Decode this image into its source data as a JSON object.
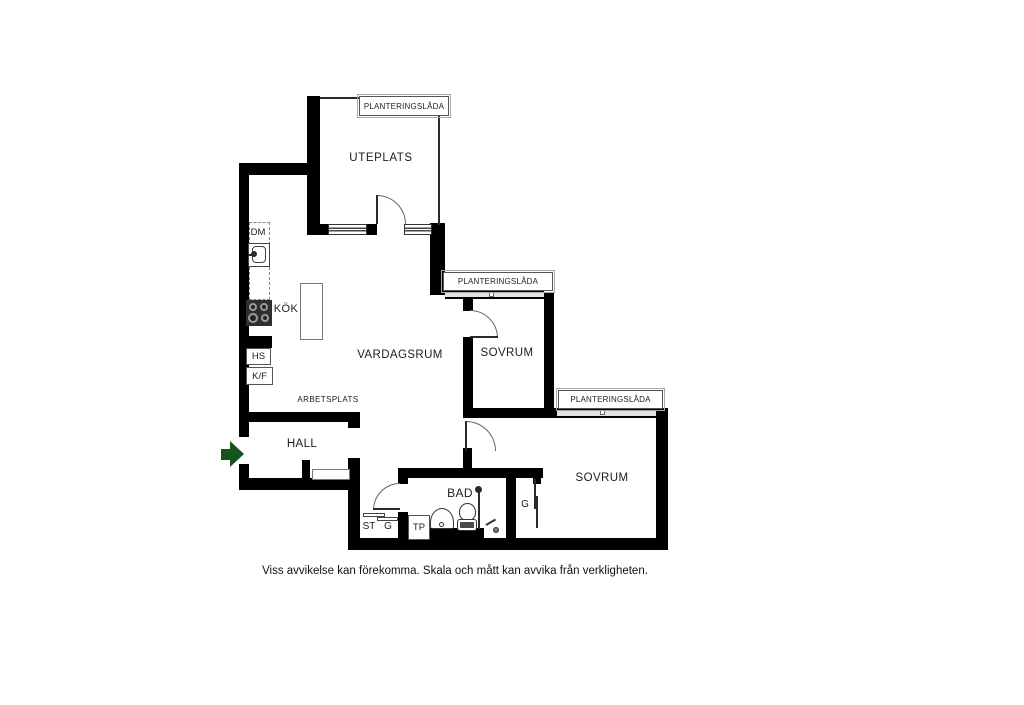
{
  "fp": {
    "planter_label": "PLANTERINGSLÅDA",
    "rooms": {
      "uteplats": "UTEPLATS",
      "vardagsrum": "VARDAGSRUM",
      "kok": "KÖK",
      "sovrum_1": "SOVRUM",
      "sovrum_2": "SOVRUM",
      "hall": "HALL",
      "bad": "BAD",
      "arbetsplats": "ARBETSPLATS"
    },
    "appliances": {
      "dm": "DM",
      "hs": "HS",
      "kf": "K/F"
    },
    "closets": {
      "st": "ST",
      "g_hall": "G",
      "tp": "TP",
      "g_sovrum": "G"
    },
    "colors": {
      "wall": "#000000",
      "entrance_arrow": "#17541c",
      "window_band": "#e2e2e2",
      "stove": "#2f2f2f"
    },
    "disclaimer": "Viss avvikelse kan förekomma. Skala och mått kan avvika från verkligheten."
  }
}
